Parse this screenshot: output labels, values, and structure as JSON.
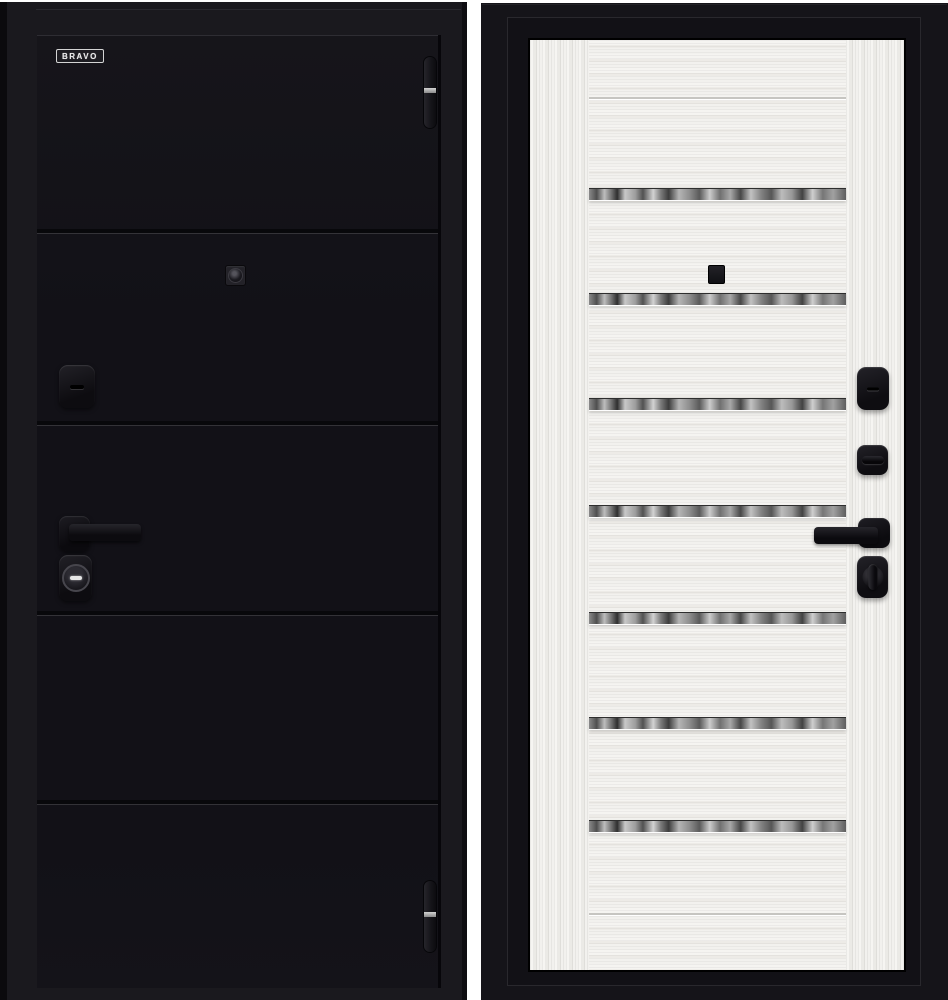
{
  "page": {
    "background_color": "#ffffff"
  },
  "product": {
    "kind": "steel-entry-door-two-views",
    "views": {
      "exterior": {
        "label": "exterior-black-door",
        "brand": {
          "label": "BRAVO"
        },
        "leaf_color": "#131117",
        "frame_color": "#1a191e",
        "groove_positions_y": [
          194,
          386,
          576,
          765
        ],
        "hinges": {
          "count": 2,
          "positions_y": [
            55,
            879
          ],
          "band_color": "#c9c9c9"
        },
        "hardware": [
          "peephole",
          "deadbolt-escutcheon",
          "lever-handle",
          "cylinder-lock"
        ]
      },
      "interior": {
        "label": "interior-white-door",
        "leaf_color": "#f4f3f0",
        "frame_color": "#151419",
        "mirror_strip_positions_y": [
          148,
          253,
          358,
          465,
          572,
          677,
          780
        ],
        "groove_positions_y": [
          57,
          873
        ],
        "hardware": [
          "peephole",
          "keyhole-plate",
          "thumbturn-plate",
          "lever-handle",
          "night-latch-knob"
        ]
      }
    }
  }
}
